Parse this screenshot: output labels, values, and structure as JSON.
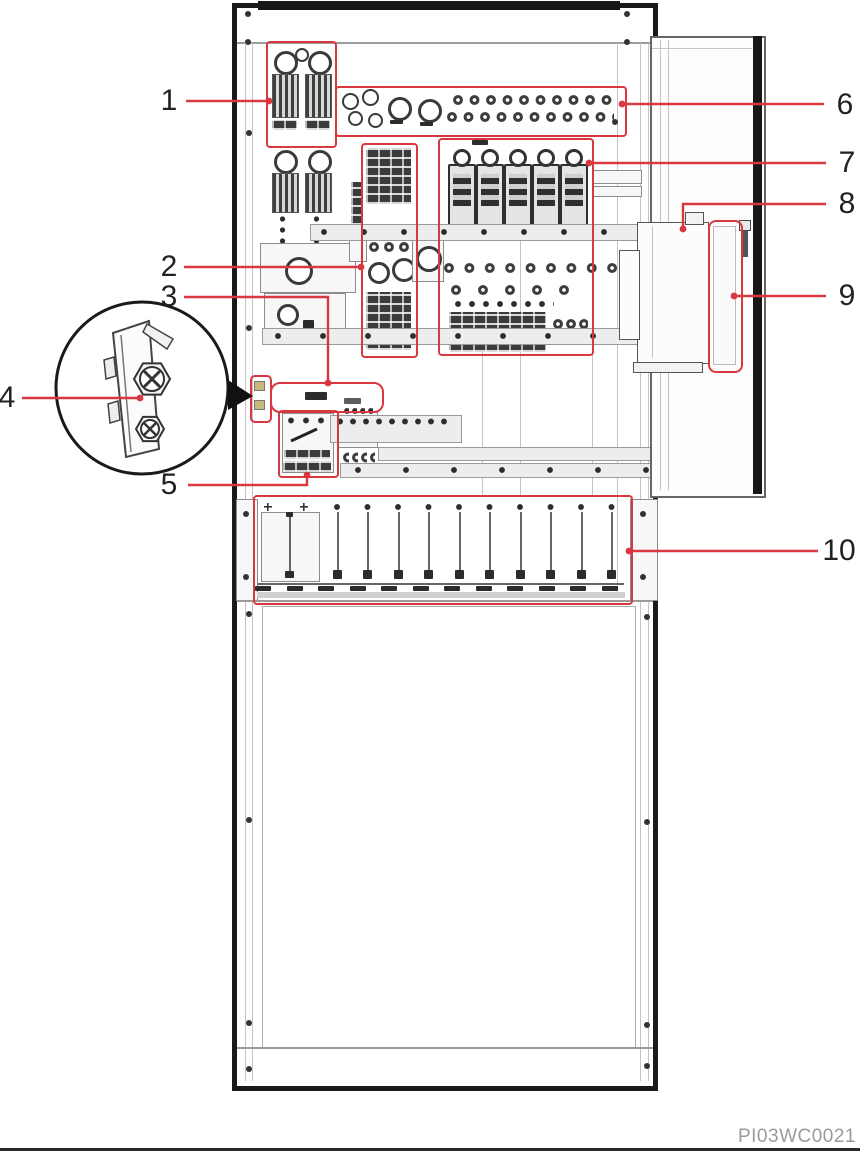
{
  "figure": {
    "title": "power-cabinet-front-view-diagram",
    "caption_code": "PI03WC0021",
    "colors": {
      "callout_red": "#d93840",
      "frame_black": "#1a1a1a",
      "line_gray": "#999999"
    },
    "module_slot_count": 12,
    "callouts": [
      {
        "num": "1",
        "target": "battery-breaker-pair"
      },
      {
        "num": "2",
        "target": "terminal-block-column"
      },
      {
        "num": "3",
        "target": "label-plate"
      },
      {
        "num": "4",
        "target": "fastening-screw-detail"
      },
      {
        "num": "5",
        "target": "transfer-switch"
      },
      {
        "num": "6",
        "target": "terminal-strip"
      },
      {
        "num": "7",
        "target": "load-breaker-group"
      },
      {
        "num": "8",
        "target": "door-mounted-controller"
      },
      {
        "num": "9",
        "target": "door-side-strip"
      },
      {
        "num": "10",
        "target": "module-shelf"
      }
    ]
  }
}
